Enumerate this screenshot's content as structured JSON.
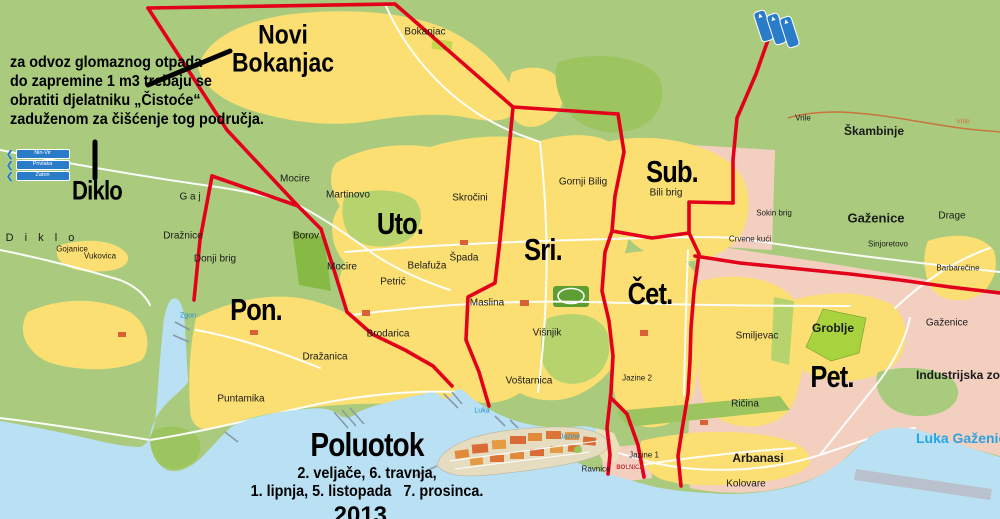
{
  "notice": {
    "text": "za odvoz glomaznog otpada\ndo zapremine 1 m3 trebaju se\nobratiti djelatniku „Čistoće“\nzaduženom za čišćenje tog područja."
  },
  "regions": {
    "diklo": "Diklo",
    "novi_bokanjac": "Novi\nBokanjac"
  },
  "zones": {
    "pon": "Pon.",
    "uto": "Uto.",
    "sri": "Sri.",
    "cet": "Čet.",
    "pet": "Pet.",
    "sub": "Sub."
  },
  "poluotok": {
    "title": "Poluotok",
    "dates": "2. veljače, 6. travnja,\n1. lipnja, 5. listopada   7. prosinca.",
    "year": "2013 ."
  },
  "map_labels": {
    "bokanjac": "Bokanjac",
    "mocire_n": "Mocire",
    "martinovo": "Martinovo",
    "skrocini": "Skročini",
    "borov": "Borov",
    "mocire_s": "Mocire",
    "belafuza": "Belafuža",
    "spada": "Špada",
    "petric": "Petrić",
    "gornji_bilig": "Gornji Bilig",
    "bili_brig": "Bili brig",
    "crvene_kuci": "Crvene kući",
    "sokin_brig": "Sokin brig",
    "skambinje": "Škambinje",
    "vrile": "Vrile",
    "vrile2": "Vrile",
    "gazenice_n": "Gaženice",
    "drage": "Drage",
    "sinjoretovo": "Sinjoretovo",
    "barbarecine": "Barbarečine",
    "gazenice_s": "Gaženice",
    "industrijska_zona": "Industrijska zona",
    "groblje": "Groblje",
    "smiljevac": "Smiljevac",
    "jazine2": "Jazine 2",
    "jazine1": "Jazine 1",
    "ravnice": "Ravnice",
    "bolnica": "BOLNICA",
    "arbanasi": "Arbanasi",
    "kolovare": "Kolovare",
    "ricina": "Ričina",
    "maslina": "Maslina",
    "visnjik": "Višnjik",
    "vostarnica": "Voštarnica",
    "puntamika": "Puntamika",
    "drazanica": "Dražanica",
    "brodarica": "Brodarica",
    "draznice": "Dražnice",
    "donji_brig": "Donji brig",
    "gaj": "G a j",
    "diklo_small": "D i k l o",
    "gojanice": "Gojanice",
    "vukovica": "Vukovica"
  },
  "sea_labels": {
    "luka_gazenice": "Luka Gaženice",
    "luka": "Luka",
    "jazine": "Jazine",
    "zgon": "Zgon"
  },
  "signs": {
    "left": [
      "Nin-Vir",
      "Privlaka",
      "Zaton"
    ],
    "up_arrow": "▲"
  },
  "colors": {
    "land": "#aacb7e",
    "sea": "#b9e1f3",
    "urban": "#fcdf72",
    "industrial_pink": "#f3cfc0",
    "boundary_red": "#e3001b",
    "road_white": "#ffffff"
  }
}
